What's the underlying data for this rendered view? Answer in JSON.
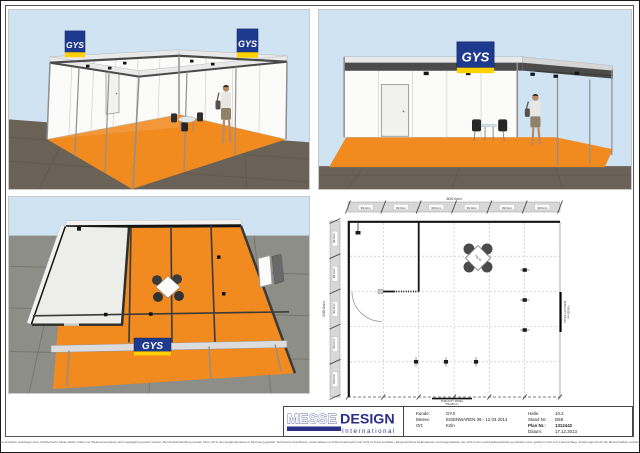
{
  "brand": {
    "logo_text": "GYS"
  },
  "colors": {
    "booth-orange": "#f18a1f",
    "gys-blue": "#1e3a8f",
    "gys-yellow": "#ffd100",
    "messe-blue": "#2b2f86",
    "sky": "#cfe3f2",
    "dark-floor": "#6b6257",
    "tile-floor": "#8e8e89"
  },
  "floor_plan": {
    "total_width": "600.0cm",
    "total_depth": "500.0cm",
    "top_segments": [
      "99.0cm",
      "99.0cm",
      "99.0cm",
      "99.0cm",
      "99.0cm",
      "99.0cm"
    ],
    "left_segments": [
      "99.0cm",
      "99.0cm",
      "99.0cm",
      "99.0cm",
      "99.0cm"
    ],
    "table_label": "70x70",
    "publicity_right_line1": "PUBLICITY PANEL",
    "publicity_right_line2": "H50/150 cm",
    "publicity_bottom_line1": "PUBLICITY PANEL",
    "publicity_bottom_line2": "H50/150 cm"
  },
  "title_block": {
    "logo_outline": "MESSE",
    "logo_solid": "DESIGN",
    "logo_subtitle": "International",
    "fields_left": [
      {
        "label": "Kunde:",
        "value": "GYS"
      },
      {
        "label": "Messe:",
        "value": "EISENWAREN 09.- 12.03.2014"
      },
      {
        "label": "Ort:",
        "value": "Köln"
      }
    ],
    "fields_right": [
      {
        "label": "Halle:",
        "value": "10.2"
      },
      {
        "label": "Stand Nr.:",
        "value": "D68"
      },
      {
        "label": "Plan Nr.:",
        "value": "1312442"
      },
      {
        "label": "Datum:",
        "value": "17.12.2013"
      }
    ]
  },
  "page": {
    "disclaimer": "Unsere Entwürfe unterliegen dem Urheberrecht. Diese dürfen dritten zur Weiterverwendung nicht zugänglich gemacht werden. Bei Zuwiderhandlung werden Ihnen 40 % des Angebotspreises in Rechnung gestellt. Technische Anschlüsse, sowie Wasser und Stromverbrauch sind nicht im Preis enthalten. Eingezeichnete Dekorationen und Gegenstände, die nicht in der Leistungsbeschreibung enthalten sind, gehören nicht zum Lieferumfang. Änderungen durch die Messe bleiben vorbehalten."
  }
}
